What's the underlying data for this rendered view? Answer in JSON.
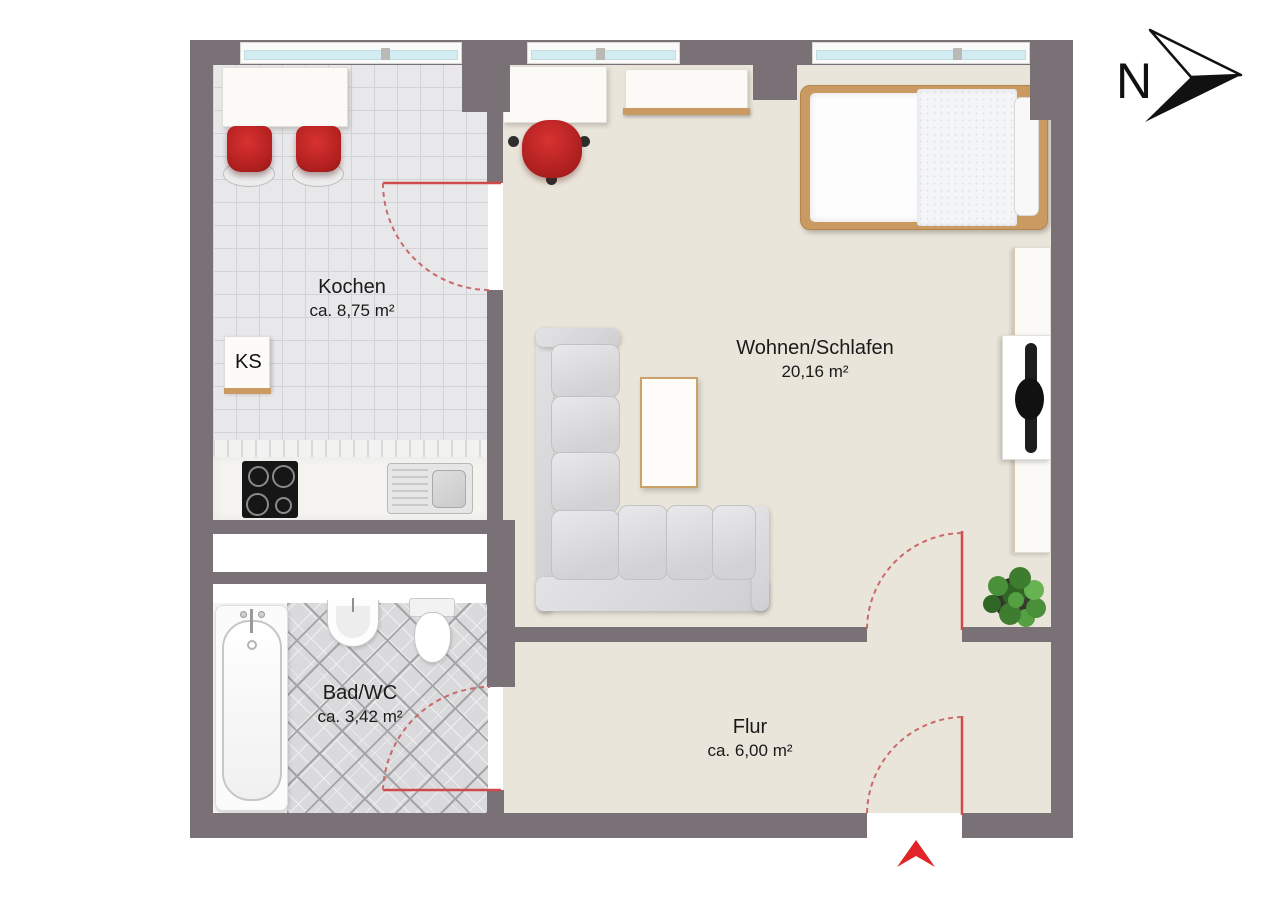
{
  "compass": {
    "label": "N"
  },
  "rooms": {
    "kochen": {
      "name": "Kochen",
      "area": "ca. 8,75 m²"
    },
    "wohnen_schlafen": {
      "name": "Wohnen/Schlafen",
      "area": "20,16 m²"
    },
    "bad_wc": {
      "name": "Bad/WC",
      "area": "ca. 3,42 m²"
    },
    "flur": {
      "name": "Flur",
      "area": "ca. 6,00 m²"
    }
  },
  "kitchen": {
    "fridge_label": "KS"
  },
  "entrance": {
    "marker": "entrance-arrow"
  },
  "furniture": {
    "kochen": [
      "dining-table",
      "red-chair",
      "red-chair",
      "fridge",
      "cooktop",
      "kitchen-sink",
      "counter"
    ],
    "wohnen_schlafen": [
      "desk",
      "office-chair",
      "wall-shelf",
      "bed",
      "corner-sofa",
      "coffee-table",
      "sideboard",
      "tv",
      "plant"
    ],
    "bad_wc": [
      "bathtub",
      "washbasin",
      "toilet"
    ]
  },
  "colors": {
    "wall": "#7a7176",
    "living_floor": "#eae5da",
    "kitchen_tile": "#e8e8ea",
    "bath_tile": "#dadadc",
    "accent_red": "#d42a28",
    "door_red": "#cf4a4a",
    "wood": "#c99a62",
    "window_glass": "#d2ecf2"
  }
}
